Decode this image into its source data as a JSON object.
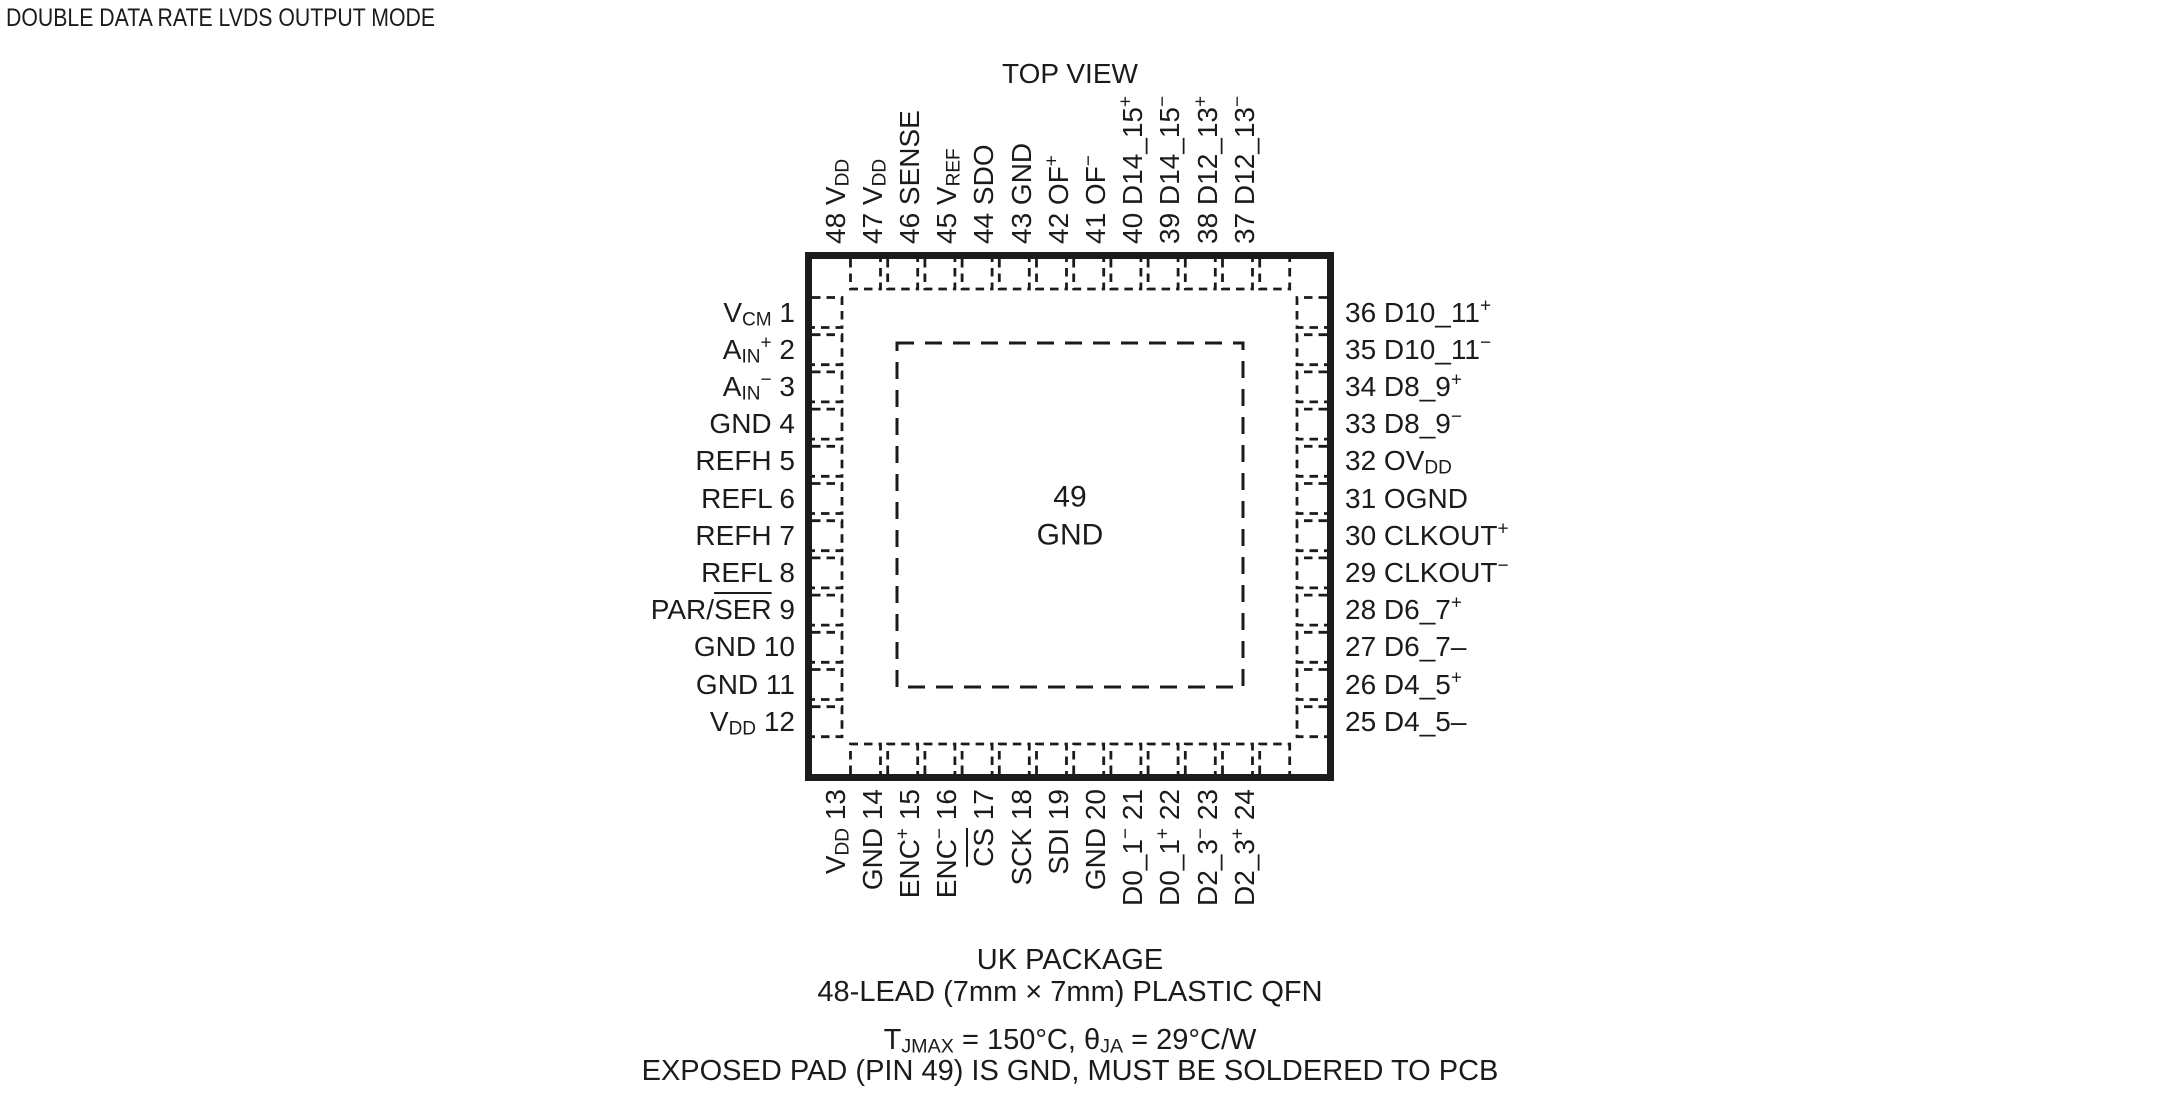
{
  "title": "DOUBLE DATA RATE LVDS OUTPUT MODE",
  "view_label": "TOP VIEW",
  "package": {
    "center_pad": {
      "number": "49",
      "name": "GND"
    },
    "pins": {
      "left": [
        {
          "num": "1",
          "name": "V[s]CM[/s]"
        },
        {
          "num": "2",
          "name": "A[s]IN[/s][u]+[/u]"
        },
        {
          "num": "3",
          "name": "A[s]IN[/s][u]−[/u]"
        },
        {
          "num": "4",
          "name": "GND"
        },
        {
          "num": "5",
          "name": "REFH"
        },
        {
          "num": "6",
          "name": "REFL"
        },
        {
          "num": "7",
          "name": "REFH"
        },
        {
          "num": "8",
          "name": "REFL"
        },
        {
          "num": "9",
          "name": "PAR/[o]SER[/o]"
        },
        {
          "num": "10",
          "name": "GND"
        },
        {
          "num": "11",
          "name": "GND"
        },
        {
          "num": "12",
          "name": "V[s]DD[/s]"
        }
      ],
      "top": [
        {
          "num": "48",
          "name": "V[s]DD[/s]"
        },
        {
          "num": "47",
          "name": "V[s]DD[/s]"
        },
        {
          "num": "46",
          "name": "SENSE"
        },
        {
          "num": "45",
          "name": "V[s]REF[/s]"
        },
        {
          "num": "44",
          "name": "SDO"
        },
        {
          "num": "43",
          "name": "GND"
        },
        {
          "num": "42",
          "name": "OF[u]+[/u]"
        },
        {
          "num": "41",
          "name": "OF[u]−[/u]"
        },
        {
          "num": "40",
          "name": "D14_15[u]+[/u]"
        },
        {
          "num": "39",
          "name": "D14_15[u]−[/u]"
        },
        {
          "num": "38",
          "name": "D12_13[u]+[/u]"
        },
        {
          "num": "37",
          "name": "D12_13[u]−[/u]"
        }
      ],
      "right": [
        {
          "num": "36",
          "name": "D10_11[u]+[/u]"
        },
        {
          "num": "35",
          "name": "D10_11[u]−[/u]"
        },
        {
          "num": "34",
          "name": "D8_9[u]+[/u]"
        },
        {
          "num": "33",
          "name": "D8_9[u]−[/u]"
        },
        {
          "num": "32",
          "name": "OV[s]DD[/s]"
        },
        {
          "num": "31",
          "name": "OGND"
        },
        {
          "num": "30",
          "name": "CLKOUT[u]+[/u]"
        },
        {
          "num": "29",
          "name": "CLKOUT[u]−[/u]"
        },
        {
          "num": "28",
          "name": "D6_7[u]+[/u]"
        },
        {
          "num": "27",
          "name": "D6_7–"
        },
        {
          "num": "26",
          "name": "D4_5[u]+[/u]"
        },
        {
          "num": "25",
          "name": "D4_5–"
        }
      ],
      "bottom": [
        {
          "num": "13",
          "name": "V[s]DD[/s]"
        },
        {
          "num": "14",
          "name": "GND"
        },
        {
          "num": "15",
          "name": "ENC[u]+[/u]"
        },
        {
          "num": "16",
          "name": "ENC[u]−[/u]"
        },
        {
          "num": "17",
          "name": "[o]CS[/o]"
        },
        {
          "num": "18",
          "name": "SCK"
        },
        {
          "num": "19",
          "name": "SDI"
        },
        {
          "num": "20",
          "name": "GND"
        },
        {
          "num": "21",
          "name": "D0_1[u]−[/u]"
        },
        {
          "num": "22",
          "name": "D0_1[u]+[/u]"
        },
        {
          "num": "23",
          "name": "D2_3[u]−[/u]"
        },
        {
          "num": "24",
          "name": "D2_3[u]+[/u]"
        }
      ]
    }
  },
  "footer": {
    "line1": "UK PACKAGE",
    "line2": "48-LEAD (7mm × 7mm) PLASTIC QFN",
    "line3": "T[s]JMAX[/s] = 150°C, θ[s]JA[/s] = 29°C/W",
    "line4": "EXPOSED PAD (PIN 49) IS GND, MUST BE SOLDERED TO PCB"
  },
  "colors": {
    "ink": "#1b1b1b",
    "background": "#ffffff"
  }
}
